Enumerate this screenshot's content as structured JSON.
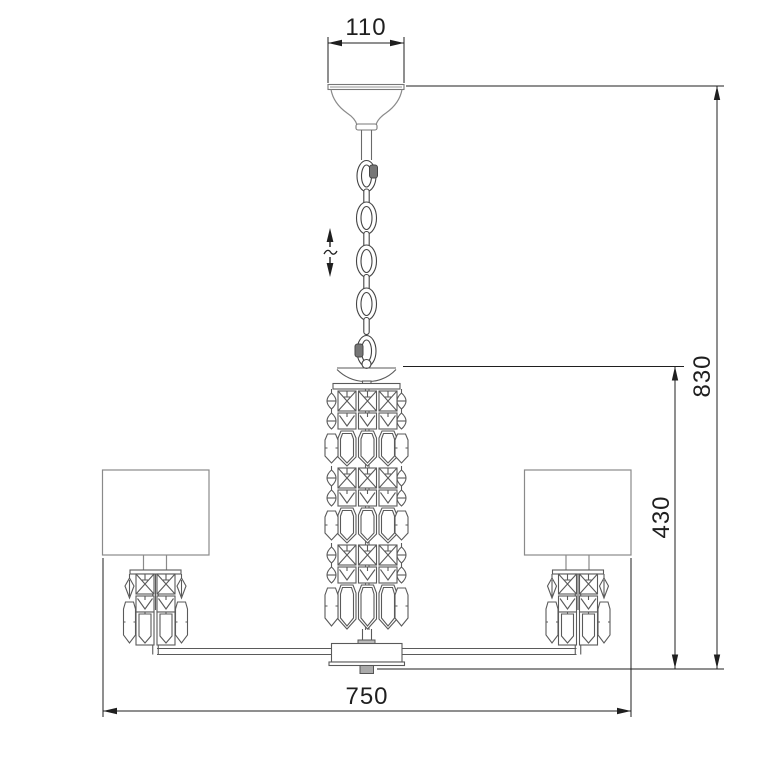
{
  "drawing": {
    "dimensions": {
      "canopy_width": "110",
      "overall_height": "830",
      "body_height": "430",
      "overall_width": "750"
    },
    "symbols": {
      "height_adjust": "double-vertical-arrow-with-tilde"
    },
    "colors": {
      "background": "#ffffff",
      "dimension_lines": "#1f1f1f",
      "fixture_lines": "#5a5a5a",
      "shade_lines": "#8a8a8a"
    }
  }
}
